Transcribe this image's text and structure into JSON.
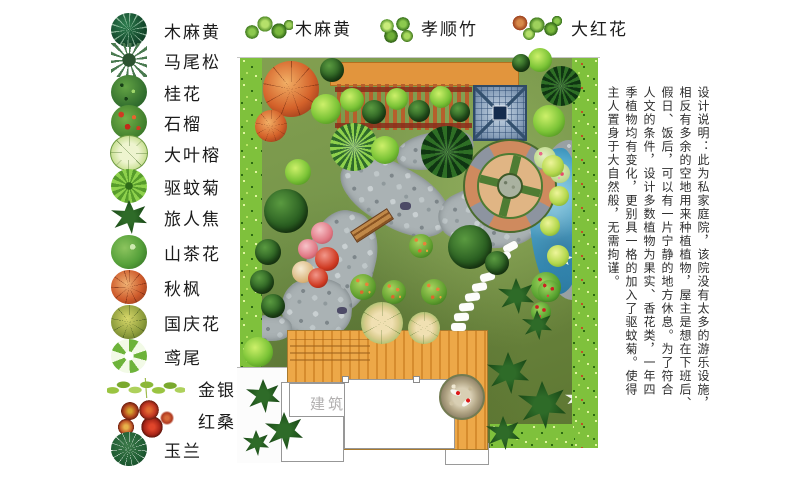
{
  "legend_left": {
    "items": [
      {
        "label": "木麻黄",
        "icon": "casuarina-icon"
      },
      {
        "label": "马尾松",
        "icon": "masson-pine-icon"
      },
      {
        "label": "桂花",
        "icon": "osmanthus-icon"
      },
      {
        "label": "石榴",
        "icon": "pomegranate-icon"
      },
      {
        "label": "大叶榕",
        "icon": "large-leaf-ficus-icon"
      },
      {
        "label": "驱蚊菊",
        "icon": "mosquito-chrysanthemum-icon"
      },
      {
        "label": "旅人焦",
        "icon": "travelers-palm-icon"
      },
      {
        "label": "山茶花",
        "icon": "camellia-icon"
      },
      {
        "label": "秋枫",
        "icon": "autumn-maple-icon"
      },
      {
        "label": "国庆花",
        "icon": "national-day-flower-icon"
      },
      {
        "label": "鸢尾",
        "icon": "iris-icon"
      },
      {
        "label": "金银花",
        "icon": "honeysuckle-icon"
      },
      {
        "label": "红桑",
        "icon": "red-mulberry-icon"
      },
      {
        "label": "玉兰",
        "icon": "magnolia-icon"
      }
    ]
  },
  "legend_top": {
    "items": [
      {
        "label": "木麻黄",
        "icon": "casuarina-cluster-icon"
      },
      {
        "label": "孝顺竹",
        "icon": "hedge-bamboo-icon"
      },
      {
        "label": "大红花",
        "icon": "hibiscus-icon"
      }
    ]
  },
  "design_note": {
    "lines": [
      "设计说明：此为私家庭院，该院没有太多的游乐设施，",
      "相反有多余的空地用来种植植物，屋主是想在下班后、",
      "假日、饭后，可以有一片宁静的地方休息。为了符合",
      "人文的条件，设计多数植物为果实、香花类，一年四",
      "季植物均有变化，更别具一格的加入了驱蚊菊。使得",
      "主人置身于大自然般，无需拘谨。"
    ]
  },
  "plan": {
    "building_label": "建筑",
    "colors": {
      "lawn": "#75944a",
      "hedge": "#7fc13c",
      "deck": "#eda848",
      "path": "#aab2b4",
      "water": "#3f9ec7",
      "plaza_brick": "#cf8a5e",
      "pavilion": "#8ca3bd",
      "wall_band": "#e2953d"
    },
    "trees": [
      {
        "t": "orange",
        "x": 54,
        "y": 34,
        "r": 28
      },
      {
        "t": "orange",
        "x": 34,
        "y": 71,
        "r": 16
      },
      {
        "t": "dark",
        "x": 95,
        "y": 15,
        "r": 12
      },
      {
        "t": "bright",
        "x": 89,
        "y": 54,
        "r": 15
      },
      {
        "t": "bright",
        "x": 61,
        "y": 117,
        "r": 13
      },
      {
        "t": "spiky",
        "x": 117,
        "y": 92,
        "r": 24
      },
      {
        "t": "bright",
        "x": 148,
        "y": 95,
        "r": 14
      },
      {
        "t": "darkspiky",
        "x": 210,
        "y": 97,
        "r": 26
      },
      {
        "t": "dark",
        "x": 49,
        "y": 156,
        "r": 22
      },
      {
        "t": "dark",
        "x": 31,
        "y": 197,
        "r": 13
      },
      {
        "t": "dark",
        "x": 25,
        "y": 227,
        "r": 12
      },
      {
        "t": "dark",
        "x": 36,
        "y": 251,
        "r": 12
      },
      {
        "t": "pink",
        "x": 85,
        "y": 178,
        "r": 11
      },
      {
        "t": "pink",
        "x": 71,
        "y": 194,
        "r": 10
      },
      {
        "t": "red",
        "x": 90,
        "y": 204,
        "r": 12
      },
      {
        "t": "tanw",
        "x": 66,
        "y": 217,
        "r": 11
      },
      {
        "t": "red",
        "x": 81,
        "y": 223,
        "r": 10
      },
      {
        "t": "flower",
        "x": 184,
        "y": 191,
        "r": 12
      },
      {
        "t": "flower",
        "x": 126,
        "y": 232,
        "r": 13
      },
      {
        "t": "flower",
        "x": 157,
        "y": 237,
        "r": 12
      },
      {
        "t": "flower",
        "x": 197,
        "y": 237,
        "r": 13
      },
      {
        "t": "fig",
        "x": 145,
        "y": 268,
        "r": 21
      },
      {
        "t": "fig",
        "x": 187,
        "y": 273,
        "r": 16
      },
      {
        "t": "dark",
        "x": 233,
        "y": 192,
        "r": 22
      },
      {
        "t": "dark",
        "x": 260,
        "y": 208,
        "r": 12
      },
      {
        "t": "camellia",
        "x": 309,
        "y": 232,
        "r": 15
      },
      {
        "t": "darkspiky",
        "x": 324,
        "y": 31,
        "r": 20
      },
      {
        "t": "bright",
        "x": 312,
        "y": 66,
        "r": 16
      },
      {
        "t": "pinkdots",
        "x": 308,
        "y": 103,
        "r": 11
      },
      {
        "t": "pinkdots",
        "x": 323,
        "y": 118,
        "r": 10
      },
      {
        "t": "yellow",
        "x": 316,
        "y": 111,
        "r": 11
      },
      {
        "t": "yellow",
        "x": 322,
        "y": 141,
        "r": 10
      },
      {
        "t": "yellow",
        "x": 313,
        "y": 171,
        "r": 10
      },
      {
        "t": "yellow",
        "x": 321,
        "y": 201,
        "r": 11
      },
      {
        "t": "camellia",
        "x": 312,
        "y": 236,
        "r": 11
      },
      {
        "t": "camellia",
        "x": 304,
        "y": 257,
        "r": 10
      },
      {
        "t": "star",
        "x": 279,
        "y": 241,
        "r": 18
      },
      {
        "t": "star",
        "x": 300,
        "y": 270,
        "r": 15
      },
      {
        "t": "star",
        "x": 271,
        "y": 318,
        "r": 21
      },
      {
        "t": "star",
        "x": 305,
        "y": 350,
        "r": 24
      },
      {
        "t": "star",
        "x": 266,
        "y": 378,
        "r": 17
      },
      {
        "t": "bright",
        "x": 21,
        "y": 297,
        "r": 15
      },
      {
        "t": "star",
        "x": 26,
        "y": 341,
        "r": 17
      },
      {
        "t": "star",
        "x": 47,
        "y": 376,
        "r": 19
      },
      {
        "t": "star",
        "x": 19,
        "y": 388,
        "r": 13
      },
      {
        "t": "bright",
        "x": 115,
        "y": 45,
        "r": 12
      },
      {
        "t": "dark",
        "x": 137,
        "y": 57,
        "r": 12
      },
      {
        "t": "bright",
        "x": 160,
        "y": 44,
        "r": 11
      },
      {
        "t": "dark",
        "x": 182,
        "y": 56,
        "r": 11
      },
      {
        "t": "bright",
        "x": 204,
        "y": 42,
        "r": 11
      },
      {
        "t": "dark",
        "x": 223,
        "y": 57,
        "r": 10
      },
      {
        "t": "bright",
        "x": 303,
        "y": 5,
        "r": 12
      },
      {
        "t": "dark",
        "x": 284,
        "y": 8,
        "r": 9
      }
    ],
    "stepping_stones": [
      {
        "x": 266,
        "y": 188,
        "rot": -28
      },
      {
        "x": 259,
        "y": 198,
        "rot": -25
      },
      {
        "x": 251,
        "y": 208,
        "rot": -20
      },
      {
        "x": 243,
        "y": 218,
        "rot": -15
      },
      {
        "x": 235,
        "y": 228,
        "rot": -10
      },
      {
        "x": 228,
        "y": 238,
        "rot": -8
      },
      {
        "x": 222,
        "y": 248,
        "rot": -5
      },
      {
        "x": 217,
        "y": 258,
        "rot": -3
      },
      {
        "x": 214,
        "y": 268,
        "rot": 0
      }
    ]
  }
}
